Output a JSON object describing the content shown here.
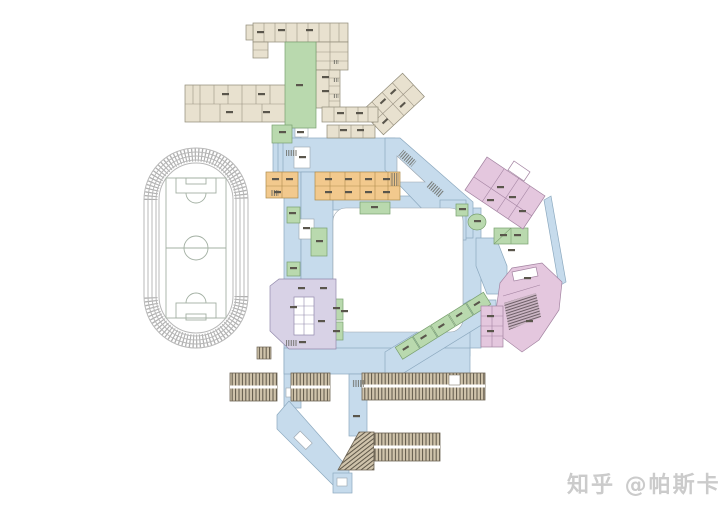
{
  "watermark": {
    "text": "知乎 @帕斯卡",
    "color": "#cbcbcb"
  },
  "palette": {
    "background": "#ffffff",
    "track_line": "#b8b8b8",
    "track_hatch": "#b0b0b0",
    "field_line": "#a3b0a3",
    "corridor_blue": "#c6dbec",
    "building_beige": "#e8e1cf",
    "courtyard_green": "#b9d9ae",
    "building_orange": "#f2c98d",
    "building_pink": "#e4c7de",
    "building_purple": "#d8d2e6",
    "parking_tan": "#cfc3ab",
    "parking_hatch": "#5c5547",
    "seat_hatch": "#6a5c64",
    "label_dash": "#5a564c",
    "room_white": "#ffffff"
  }
}
